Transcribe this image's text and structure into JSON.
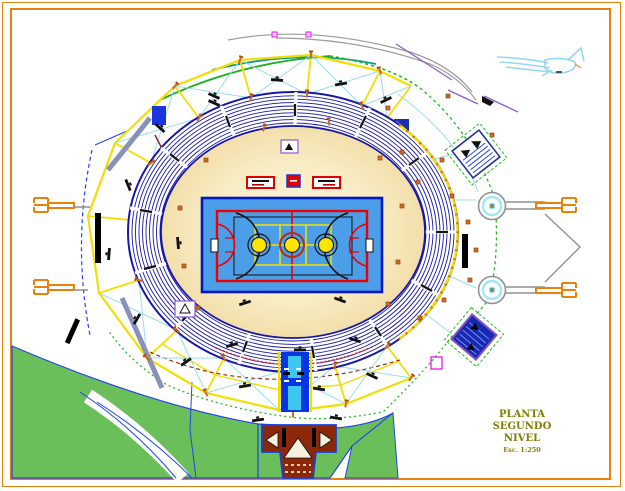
{
  "drawing": {
    "type": "CAD floor plan - stadium / coliseum with central basketball court",
    "title_block": {
      "line1": "PLANTA",
      "line2": "SEGUNDO",
      "line3": "NIVEL",
      "scale": "Esc. 1:250"
    },
    "palette": {
      "frame_orange": "#e8820c",
      "room_wall_yellow": "#f2de00",
      "truss_cyan": "#9adcf0",
      "seat_row_blue": "#1818a8",
      "concourse_cream": "#f6e7bc",
      "court_blue": "#4d9ee8",
      "court_line_red": "#ee0000",
      "court_circle_yellow": "#ffe400",
      "grass_green": "#6abf5a",
      "site_green_dash": "#22bb22",
      "stair_brown": "#8b2808",
      "corridor_blue": "#0535e5",
      "door_orange": "#d2691e",
      "wall_gray": "#8892b8",
      "canopy_purple": "#8a60c8",
      "title_olive": "#7f7f00"
    },
    "symbols": [
      {
        "name": "north-plane-icon",
        "meaning": "sketched plane / north indicator, top right"
      },
      {
        "name": "exit-fork-icon",
        "meaning": "orange gate symbols at east and west entries"
      },
      {
        "name": "column-circle-icon",
        "meaning": "round pylon with cyan core, east plaza"
      },
      {
        "name": "stair-detail-icon",
        "meaning": "rotated hatched stair towers, east side"
      },
      {
        "name": "vomitory-icon",
        "meaning": "purple tunnel boxes at bowl edge"
      }
    ]
  }
}
